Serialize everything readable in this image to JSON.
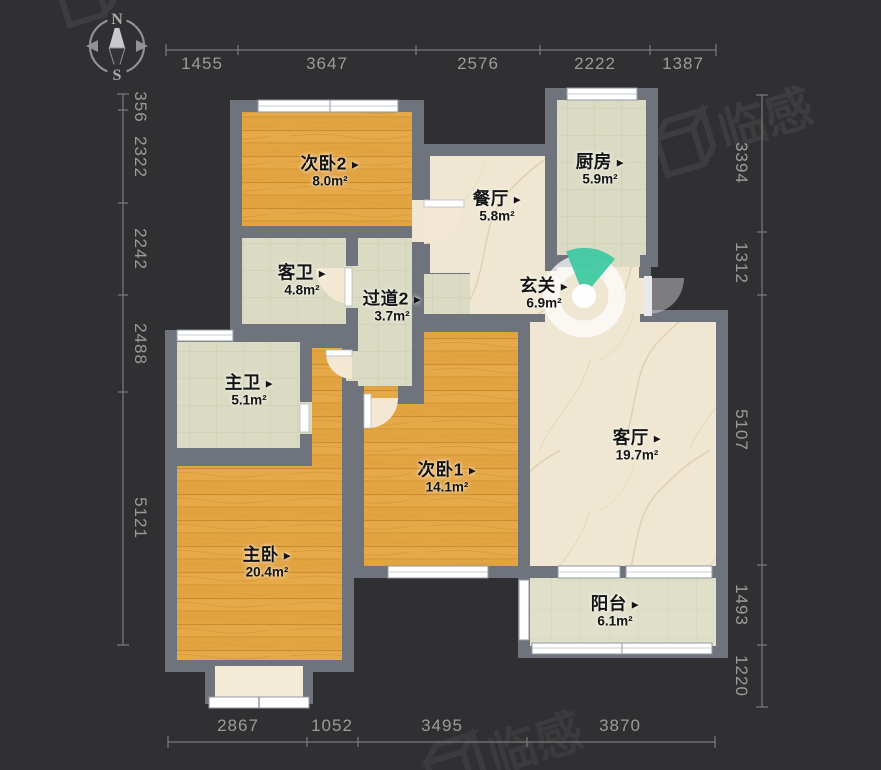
{
  "ui": {
    "arrow": "▶"
  },
  "compass": {
    "north": "N",
    "south": "S"
  },
  "watermark": {
    "text": "临感"
  },
  "colors": {
    "background": "#302F31",
    "wall": "#6F747C",
    "wood_floor": "#E2A341",
    "marble_floor": "#F0E7D2",
    "tile_floor": "#DBDBC4",
    "balcony_tile": "#E0E0CA",
    "vr_accent_teal": "#3FC9A2",
    "dimension_text": "#9A9C9B",
    "label_text": "#141414"
  },
  "rooms": [
    {
      "name": "次卧2",
      "area": "8.0m²"
    },
    {
      "name": "餐厅",
      "area": "5.8m²"
    },
    {
      "name": "厨房",
      "area": "5.9m²"
    },
    {
      "name": "客卫",
      "area": "4.8m²"
    },
    {
      "name": "过道2",
      "area": "3.7m²"
    },
    {
      "name": "玄关",
      "area": "6.9m²"
    },
    {
      "name": "主卫",
      "area": "5.1m²"
    },
    {
      "name": "次卧1",
      "area": "14.1m²"
    },
    {
      "name": "客厅",
      "area": "19.7m²"
    },
    {
      "name": "主卧",
      "area": "20.4m²"
    },
    {
      "name": "阳台",
      "area": "6.1m²"
    }
  ],
  "dimensions": {
    "top": [
      "1455",
      "3647",
      "2576",
      "2222",
      "1387"
    ],
    "bottom": [
      "2867",
      "1052",
      "3495",
      "3870"
    ],
    "left": [
      "356",
      "2322",
      "2242",
      "2488",
      "5121"
    ],
    "right": [
      "3394",
      "1312",
      "5107",
      "1493",
      "1220"
    ]
  }
}
